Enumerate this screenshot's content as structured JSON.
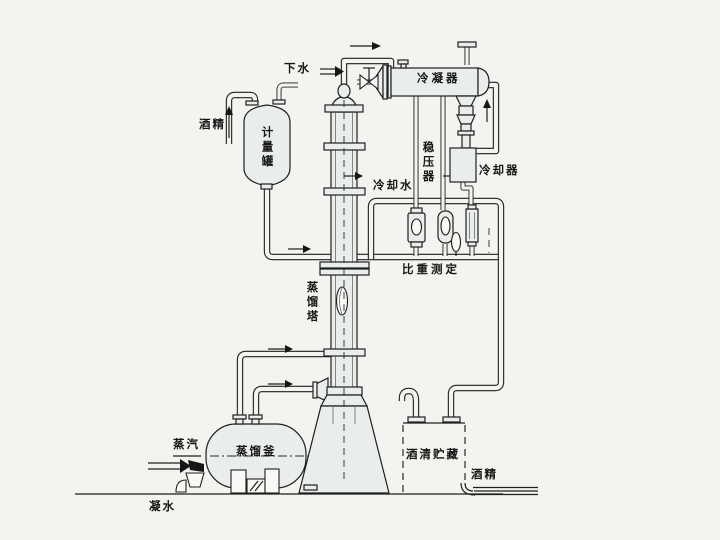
{
  "diagram": {
    "labels": {
      "drain_water": "下水",
      "condenser": "冷凝器",
      "alcohol_in": "酒精",
      "measuring_tank": "计量罐",
      "pressure_stabilizer": "稳压器",
      "cooling_water": "冷却水",
      "cooler": "冷却器",
      "specific_gravity_test": "比重测定",
      "distillation_column": "蒸馏塔",
      "distillation_still": "蒸馏釜",
      "steam": "蒸汽",
      "spirit_storage": "酒清贮藏",
      "alcohol_out": "酒精",
      "condensate": "凝水"
    },
    "colors": {
      "line": "#1f1f1f",
      "vessel_fill": "#e9edec",
      "background": "#f3f3ef"
    }
  }
}
